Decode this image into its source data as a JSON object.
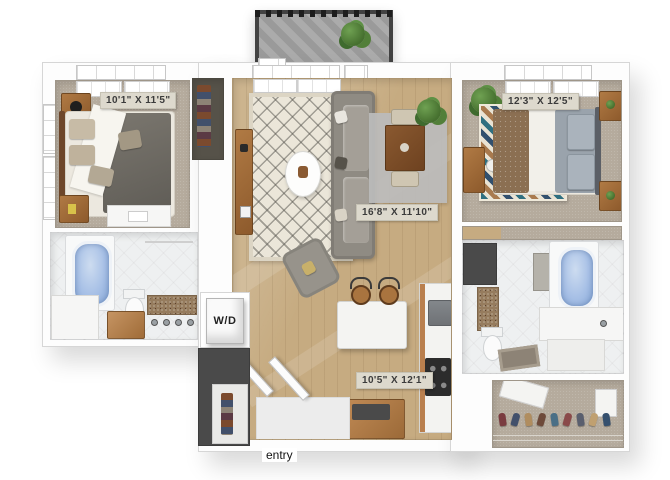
{
  "floorplan": {
    "labels": {
      "bedroom1_dimensions": "10'1\" X 11'5\"",
      "living_dimensions": "16'8\" X 11'10\"",
      "bedroom2_dimensions": "12'3\" X 12'5\"",
      "kitchen_dimensions": "10'5\" X 12'1\"",
      "laundry": "W/D",
      "entry": "entry"
    },
    "colors": {
      "wall": "#fdfdfd",
      "wood_floor": "#c6ab81",
      "carpet": "#b5ab9d",
      "tile": "#eef0f1",
      "bathtub_blue": "#a7c0e6",
      "dark_closet": "#4a4a4a",
      "balcony_railing": "#424242",
      "label_background": "#ddd9cd",
      "label_text": "#3b3b3b",
      "cabinet_wood": "#b97f4e"
    }
  }
}
